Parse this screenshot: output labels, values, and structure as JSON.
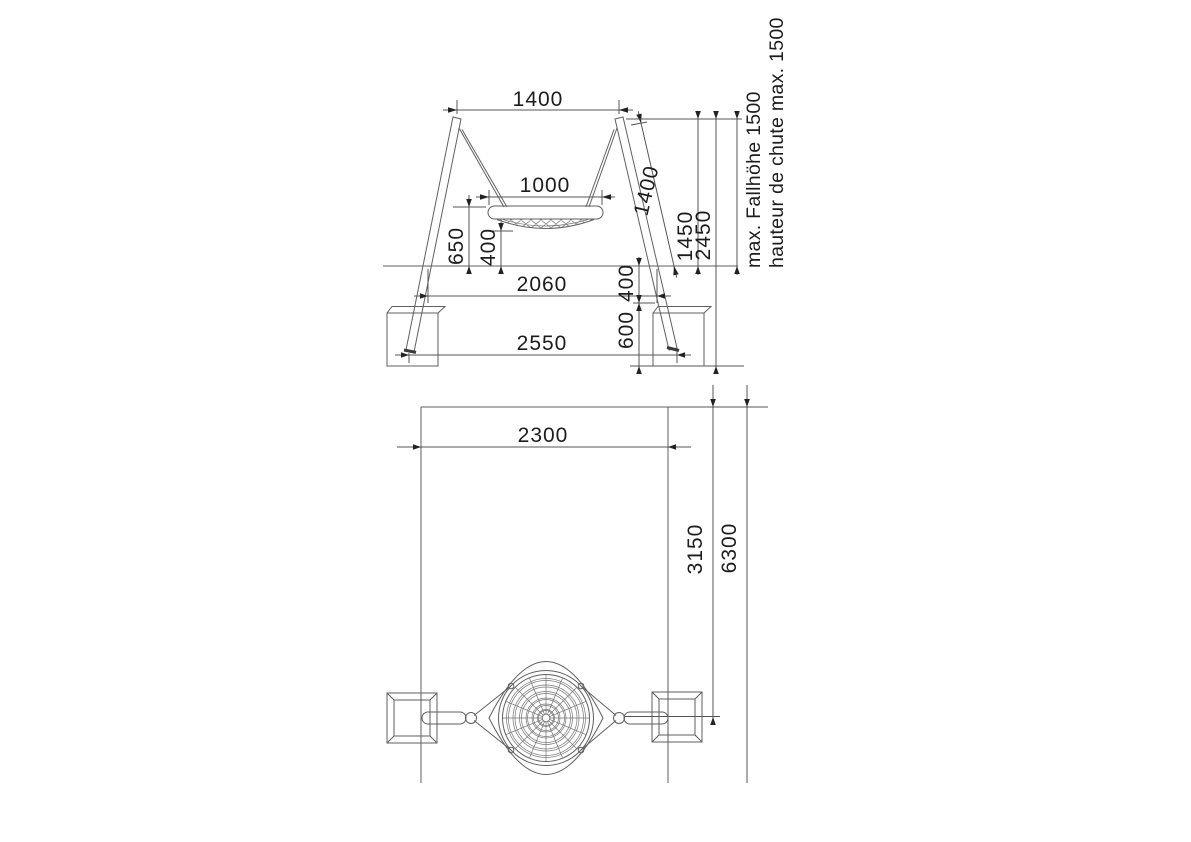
{
  "front_view": {
    "dim_top_width": "1400",
    "dim_basket_width": "1000",
    "dim_basket_top_height": "650",
    "dim_basket_clearance": "400",
    "dim_post_length": "1400",
    "dim_pivot_height": "1450",
    "dim_overall_height": "2450",
    "dim_post_spacing_ground": "2060",
    "dim_foundation_top_depth": "400",
    "dim_foundation_depth": "600",
    "dim_post_spacing_feet": "2550",
    "note_fall_height_de": "max. Fallhöhe 1500",
    "note_fall_height_fr": "hauteur de chute max. 1500"
  },
  "plan_view": {
    "dim_area_width": "2300",
    "dim_axis_distance": "3150",
    "dim_area_length": "6300"
  }
}
